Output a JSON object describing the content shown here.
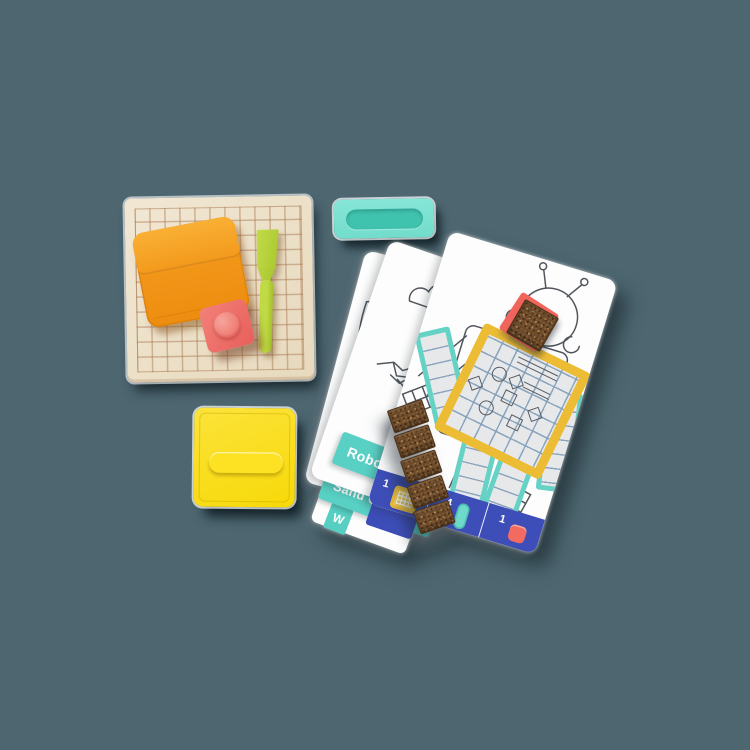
{
  "background": {
    "color": "#4d6670"
  },
  "board": {
    "surface_color": "#ece0c8",
    "grid_line_color": "#a5734b"
  },
  "tools": {
    "pouch_color": "#f29a1c",
    "spatula_color": "#b5d139",
    "stamp_color": "#ee6f68"
  },
  "cases": {
    "teal_case_color": "#7ce1d2",
    "yellow_case_color": "#fbdf17"
  },
  "cards": {
    "tab_color": "#58d0c3",
    "tabs": [
      {
        "label": "Robot"
      },
      {
        "label": "Sand Castle"
      },
      {
        "label": "W"
      }
    ],
    "front_card": {
      "design": "robot",
      "bar_color": "#3d4eb8",
      "piece_counts": [
        {
          "value": "1",
          "piece": "grid-board-piece",
          "color": "#edbc35"
        },
        {
          "value": "4",
          "piece": "strip-piece",
          "color": "#6fdacb"
        },
        {
          "value": "1",
          "piece": "square-piece",
          "color": "#f26b61"
        }
      ]
    }
  }
}
